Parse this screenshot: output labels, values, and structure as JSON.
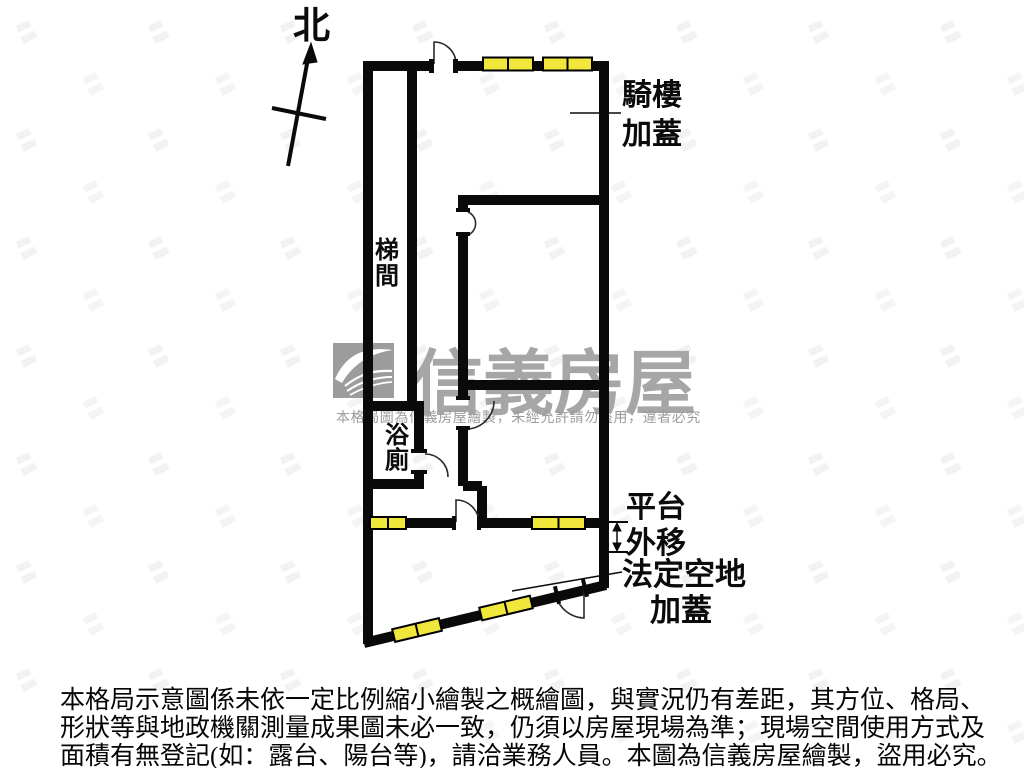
{
  "compass": {
    "label": "北"
  },
  "plan": {
    "labels": {
      "stairwell": "梯間",
      "bathroom": "浴廁",
      "arcade_line1": "騎樓",
      "arcade_line2": "加蓋",
      "platform_line1": "平台",
      "platform_line2": "外移",
      "legal_line1": "法定空地",
      "legal_line2": "加蓋"
    },
    "colors": {
      "wall": "#0a0a0a",
      "window_fill": "#f0e63c",
      "window_border": "#000000",
      "door": "#2b2b2b"
    }
  },
  "watermark": {
    "brand": "信義房屋",
    "notice": "本格局圖為信義房屋繪製，未經允許請勿盜用，違者必究",
    "brand_color": "#a6a6a6",
    "notice_color": "#9c9c9c",
    "logo_color": "#9c9c9c"
  },
  "disclaimer": {
    "line1": "本格局示意圖係未依一定比例縮小繪製之概繪圖，與實況仍有差距，其方位、格局、",
    "line2": "形狀等與地政機關測量成果圖未必一致，仍須以房屋現場為準；現場空間使用方式及",
    "line3": "面積有無登記(如：露台、陽台等)，請洽業務人員。本圖為信義房屋繪製，盜用必究。"
  }
}
